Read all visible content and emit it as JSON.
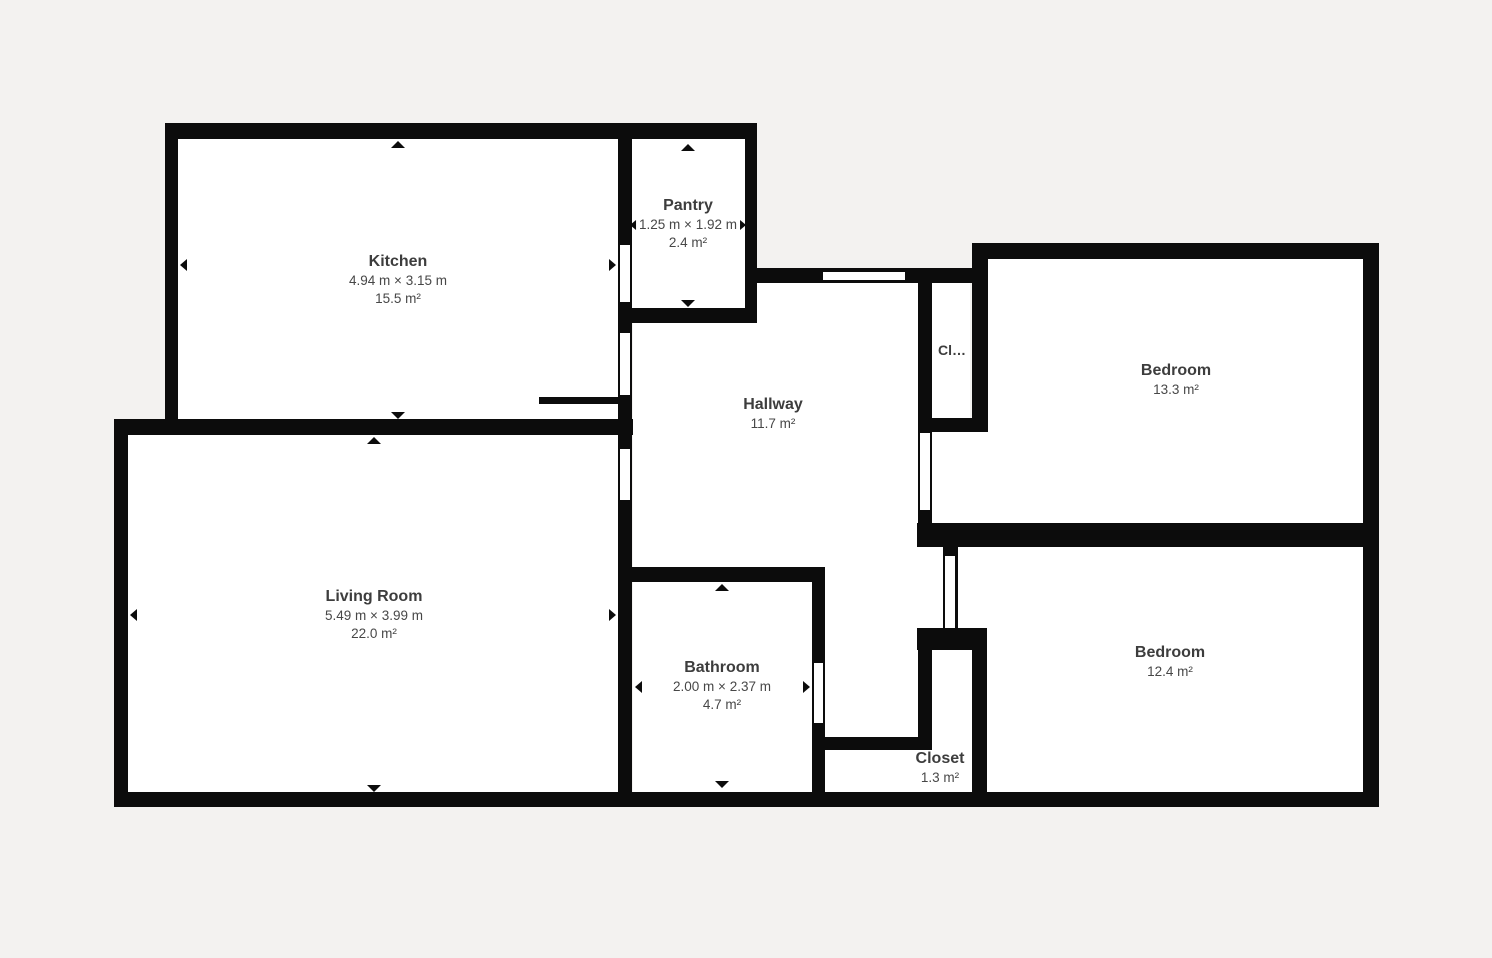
{
  "figure_type": "floor_plan",
  "colors": {
    "background": "#f3f2f0",
    "wall": "#0c0c0c",
    "room_fill": "#ffffff",
    "room_name_text": "#3d3d3d",
    "room_dim_text": "#474747"
  },
  "rooms": {
    "kitchen": {
      "name": "Kitchen",
      "dimensions": "4.94 m × 3.15 m",
      "area": "15.5 m²"
    },
    "pantry": {
      "name": "Pantry",
      "dimensions": "1.25 m × 1.92 m",
      "area": "2.4 m²"
    },
    "hallway": {
      "name": "Hallway",
      "area": "11.7 m²"
    },
    "closet_small": {
      "name": "Cl…"
    },
    "bedroom_top": {
      "name": "Bedroom",
      "area": "13.3 m²"
    },
    "living_room": {
      "name": "Living Room",
      "dimensions": "5.49 m × 3.99 m",
      "area": "22.0 m²"
    },
    "bathroom": {
      "name": "Bathroom",
      "dimensions": "2.00 m × 2.37 m",
      "area": "4.7 m²"
    },
    "closet_bottom": {
      "name": "Closet",
      "area": "1.3 m²"
    },
    "bedroom_bottom": {
      "name": "Bedroom",
      "area": "12.4 m²"
    }
  }
}
